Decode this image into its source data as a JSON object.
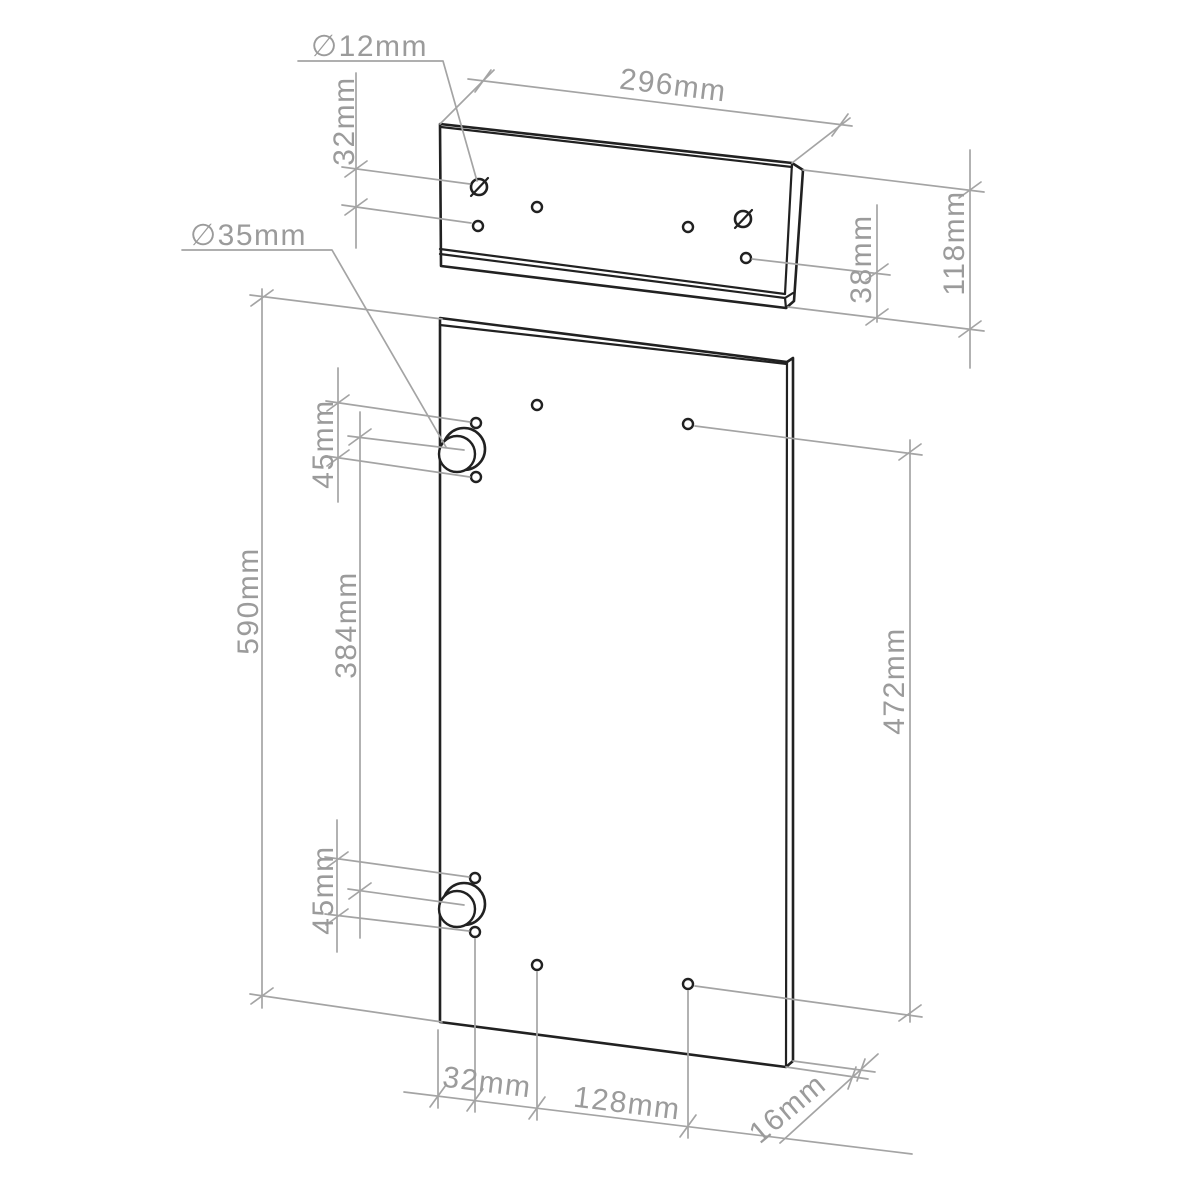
{
  "drawing": {
    "type": "furniture-part-drilling-diagram",
    "colors": {
      "background": "#ffffff",
      "part_outline": "#212121",
      "dimension_lines": "#a4a4a4",
      "dimension_text": "#9b9b9b"
    },
    "drawer_front": {
      "hole_diameter_label": "∅12mm",
      "width_label": "296mm",
      "hole_row_spacing_label": "32mm",
      "bottom_hole_offset_label": "38mm",
      "height_label": "118mm"
    },
    "door": {
      "hinge_cup_diameter_label": "∅35mm",
      "height_label": "590mm",
      "hinge_spacing_label": "384mm",
      "top_hinge_screw_spacing_label": "45mm",
      "bottom_hinge_screw_spacing_label": "45mm",
      "right_holes_spacing_label": "472mm",
      "edge_to_hole_column_label": "32mm",
      "bottom_holes_spacing_label": "128mm",
      "thickness_label": "16mm"
    }
  }
}
